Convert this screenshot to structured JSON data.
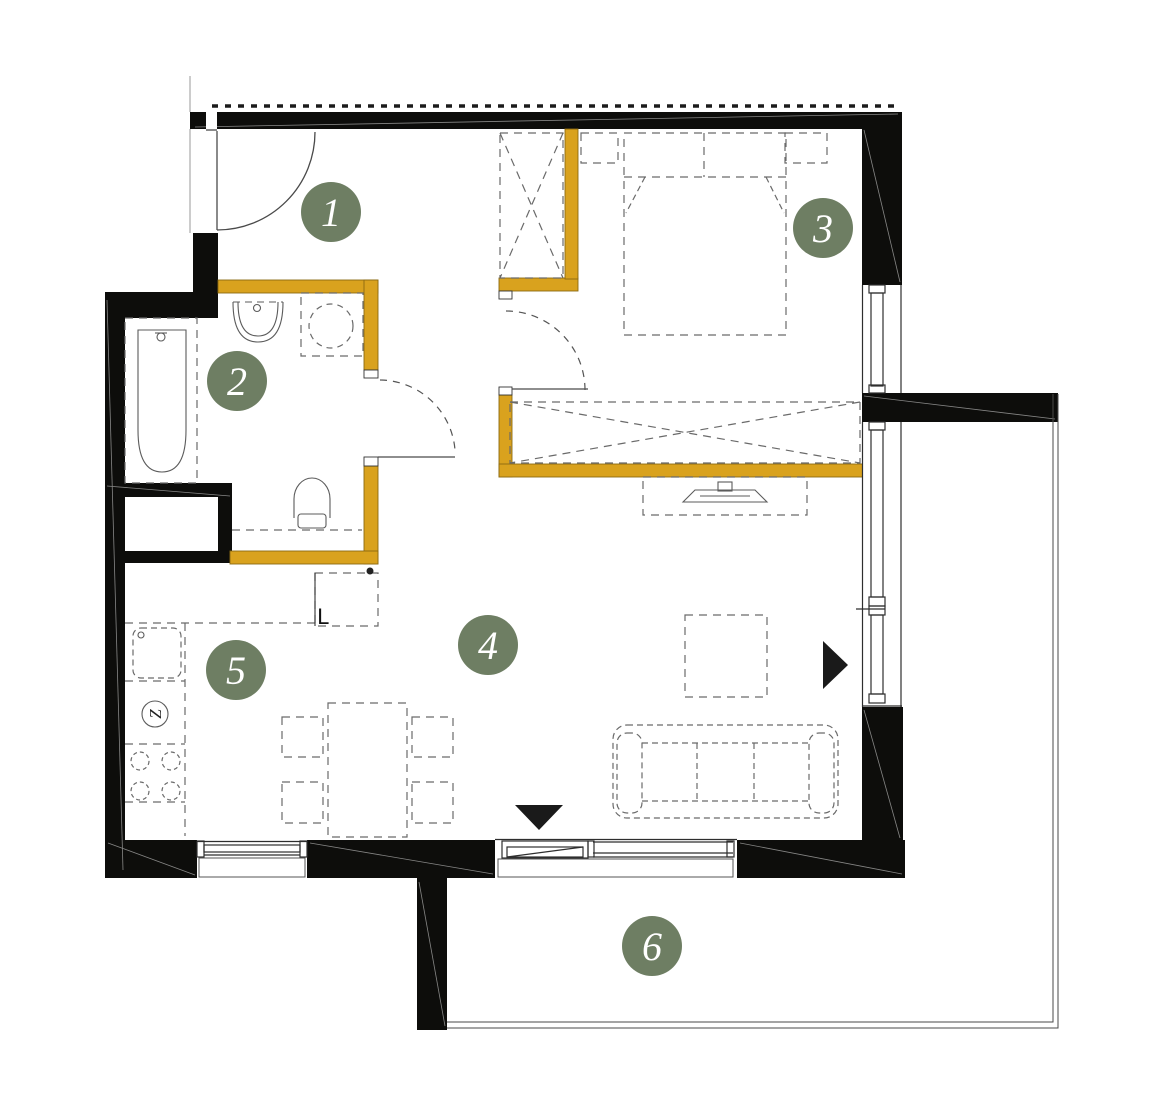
{
  "plan": {
    "rooms": [
      {
        "number": "1"
      },
      {
        "number": "2"
      },
      {
        "number": "3"
      },
      {
        "number": "4"
      },
      {
        "number": "5"
      },
      {
        "number": "6"
      }
    ],
    "labels": {
      "fridge": "L",
      "dishwasher": "Z"
    },
    "colors": {
      "wall": "#0D0D0B",
      "accent": "#D9A21E",
      "accent_stroke": "#8A6A12",
      "marker": "#6E7E63",
      "marker_text": "#FFFFFF",
      "line": "#4A4A4A",
      "furniture": "#6A6A6A"
    }
  }
}
